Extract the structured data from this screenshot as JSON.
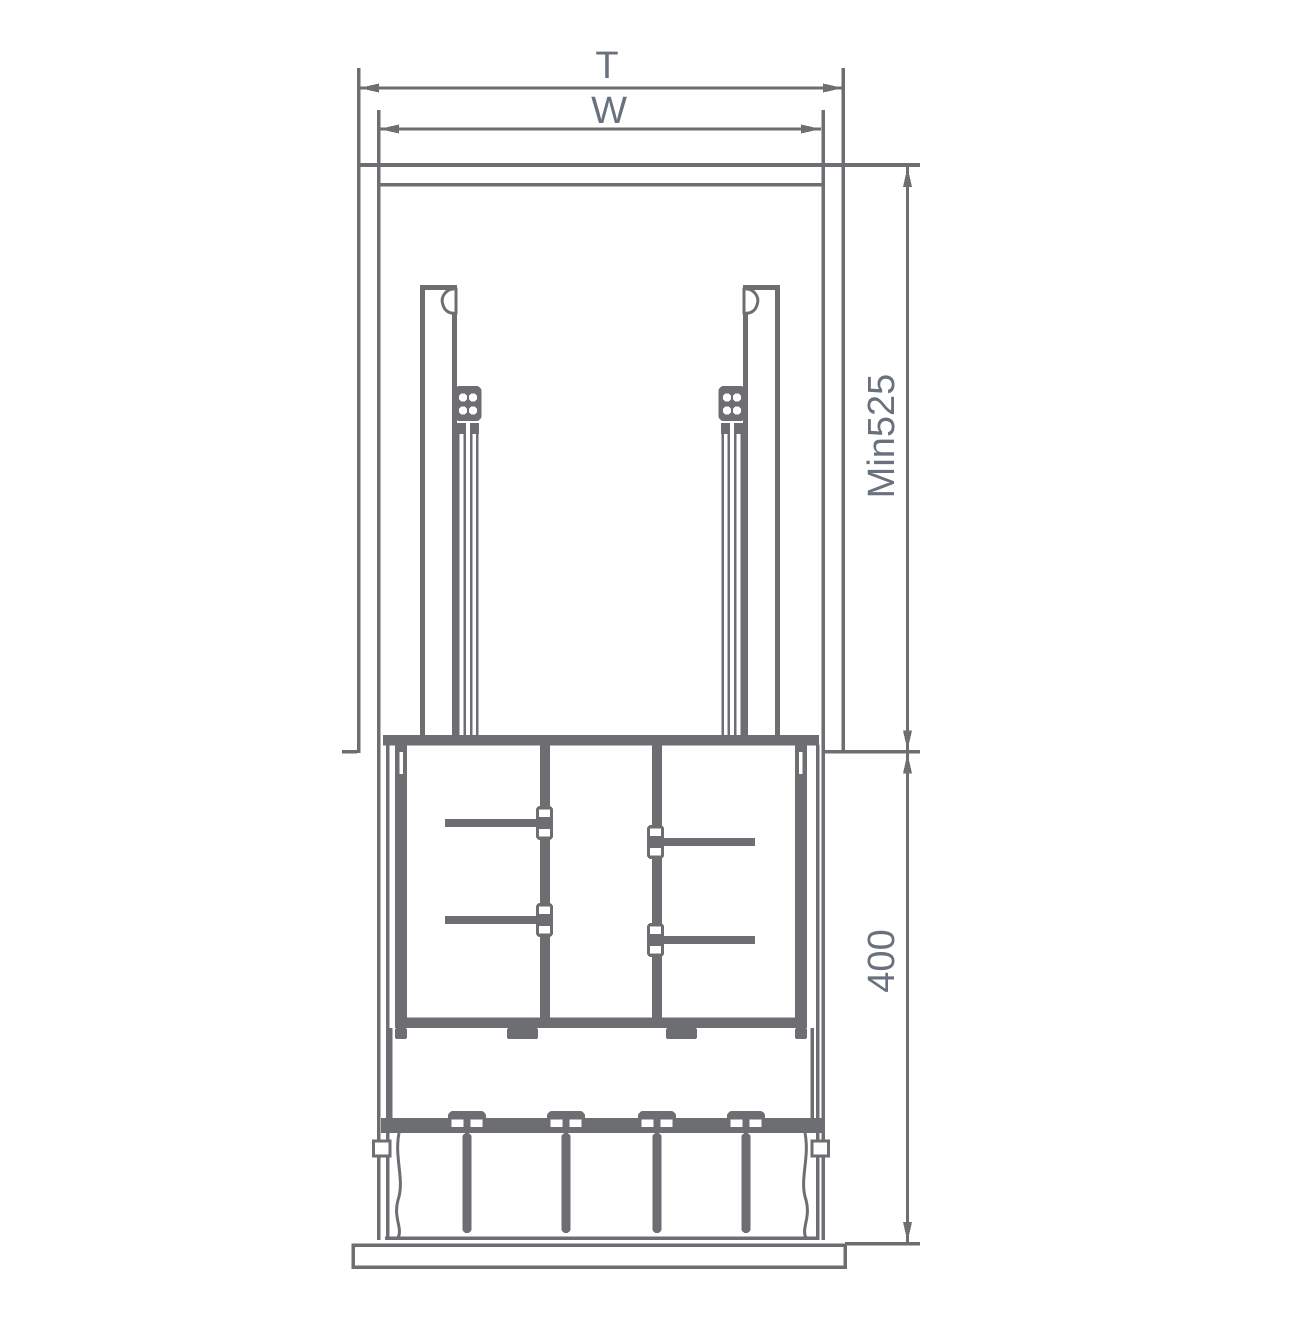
{
  "drawing": {
    "kind": "cabinet pull-down unit installation diagram",
    "dimensions": {
      "outer_width": {
        "label": "T"
      },
      "inner_width": {
        "label": "W"
      },
      "cabinet_depth": {
        "label": "Min525"
      },
      "front_height": {
        "label": "400"
      }
    },
    "colors": {
      "line": "#6d6e71",
      "dimension_text": "#68717d",
      "background": "#ffffff"
    }
  }
}
